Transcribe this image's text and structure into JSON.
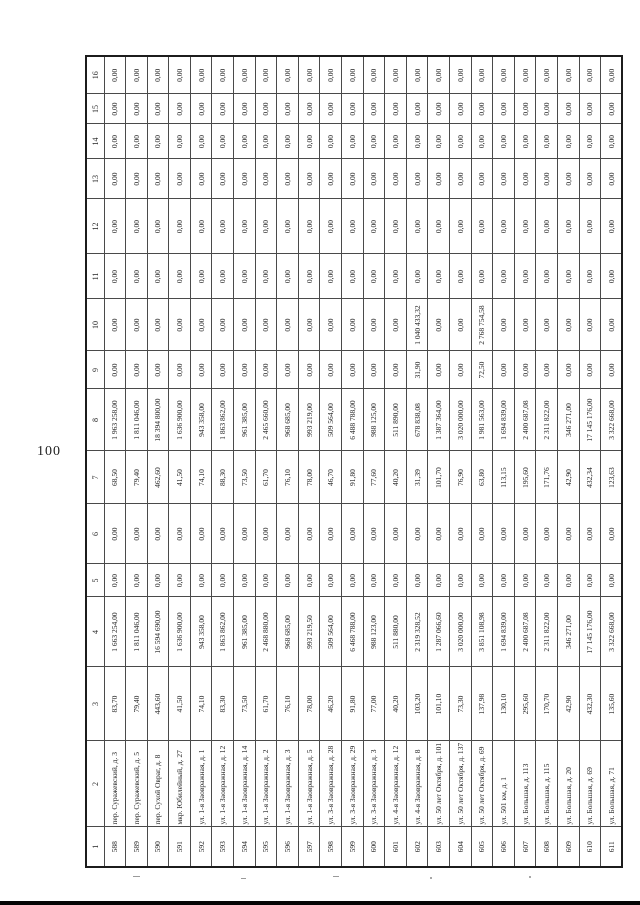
{
  "page": {
    "number": "100"
  },
  "table": {
    "col_headers": [
      "1",
      "2",
      "3",
      "4",
      "5",
      "6",
      "7",
      "8",
      "9",
      "10",
      "11",
      "12",
      "13",
      "14",
      "15",
      "16"
    ],
    "rows": [
      {
        "num": "588",
        "address": "пер. Суражевский, д. 3",
        "values": [
          "83,70",
          "1 663 254,00",
          "0,00",
          "0,00",
          "68,50",
          "1 963 258,00",
          "0,00",
          "0,00",
          "0,00",
          "0,00",
          "0,00",
          "0,00",
          "0,00",
          "0,00"
        ]
      },
      {
        "num": "589",
        "address": "пер. Суражевский, д. 5",
        "values": [
          "79,40",
          "1 811 046,00",
          "0,00",
          "0,00",
          "79,40",
          "1 811 046,00",
          "0,00",
          "0,00",
          "0,00",
          "0,00",
          "0,00",
          "0,00",
          "0,00",
          "0,00"
        ]
      },
      {
        "num": "590",
        "address": "пер. Сухой Овраг, д. 8",
        "values": [
          "443,60",
          "16 594 690,00",
          "0,00",
          "0,00",
          "462,60",
          "18 394 800,00",
          "0,00",
          "0,00",
          "0,00",
          "0,00",
          "0,00",
          "0,00",
          "0,00",
          "0,00"
        ]
      },
      {
        "num": "591",
        "address": "мкр. Юбилейный, д. 27",
        "values": [
          "41,50",
          "1 636 900,00",
          "0,00",
          "0,00",
          "41,50",
          "1 636 900,00",
          "0,00",
          "0,00",
          "0,00",
          "0,00",
          "0,00",
          "0,00",
          "0,00",
          "0,00"
        ]
      },
      {
        "num": "592",
        "address": "ул. 1-я Заовражная, д. 1",
        "values": [
          "74,10",
          "943 358,00",
          "0,00",
          "0,00",
          "74,10",
          "943 358,00",
          "0,00",
          "0,00",
          "0,00",
          "0,00",
          "0,00",
          "0,00",
          "0,00",
          "0,00"
        ]
      },
      {
        "num": "593",
        "address": "ул. 1-я Заовражная, д. 12",
        "values": [
          "83,30",
          "1 863 862,00",
          "0,00",
          "0,00",
          "88,30",
          "1 863 862,00",
          "0,00",
          "0,00",
          "0,00",
          "0,00",
          "0,00",
          "0,00",
          "0,00",
          "0,00"
        ]
      },
      {
        "num": "594",
        "address": "ул. 1-я Заовражная, д. 14",
        "values": [
          "73,50",
          "961 385,00",
          "0,00",
          "0,00",
          "73,50",
          "961 385,00",
          "0,00",
          "0,00",
          "0,00",
          "0,00",
          "0,00",
          "0,00",
          "0,00",
          "0,00"
        ]
      },
      {
        "num": "595",
        "address": "ул. 1-я Заовражная, д. 2",
        "values": [
          "61,70",
          "2 468 880,00",
          "0,00",
          "0,00",
          "61,70",
          "2 465 660,00",
          "0,00",
          "0,00",
          "0,00",
          "0,00",
          "0,00",
          "0,00",
          "0,00",
          "0,00"
        ]
      },
      {
        "num": "596",
        "address": "ул. 1-я Заовражная, д. 3",
        "values": [
          "76,10",
          "968 685,00",
          "0,00",
          "0,00",
          "76,10",
          "968 685,00",
          "0,00",
          "0,00",
          "0,00",
          "0,00",
          "0,00",
          "0,00",
          "0,00",
          "0,00"
        ]
      },
      {
        "num": "597",
        "address": "ул. 1-я Заовражная, д. 5",
        "values": [
          "78,00",
          "993 219,50",
          "0,00",
          "0,00",
          "78,00",
          "993 219,00",
          "0,00",
          "0,00",
          "0,00",
          "0,00",
          "0,00",
          "0,00",
          "0,00",
          "0,00"
        ]
      },
      {
        "num": "598",
        "address": "ул. 3-я Заовражная, д. 28",
        "values": [
          "46,20",
          "509 564,00",
          "0,00",
          "0,00",
          "46,70",
          "509 564,00",
          "0,00",
          "0,00",
          "0,00",
          "0,00",
          "0,00",
          "0,00",
          "0,00",
          "0,00"
        ]
      },
      {
        "num": "599",
        "address": "ул. 3-я Заовражная, д. 29",
        "values": [
          "91,80",
          "6 468 788,00",
          "0,00",
          "0,00",
          "91,80",
          "6 488 788,00",
          "0,00",
          "0,00",
          "0,00",
          "0,00",
          "0,00",
          "0,00",
          "0,00",
          "0,00"
        ]
      },
      {
        "num": "600",
        "address": "ул. 3-я Заовражная, д. 3",
        "values": [
          "77,00",
          "988 123,00",
          "0,00",
          "0,00",
          "77,60",
          "988 125,00",
          "0,00",
          "0,00",
          "0,00",
          "0,00",
          "0,00",
          "0,00",
          "0,00",
          "0,00"
        ]
      },
      {
        "num": "601",
        "address": "ул. 4-я Заовражная, д. 12",
        "values": [
          "40,20",
          "511 880,00",
          "0,00",
          "0,00",
          "40,20",
          "511 890,00",
          "0,00",
          "0,00",
          "0,00",
          "0,00",
          "0,00",
          "0,00",
          "0,00",
          "0,00"
        ]
      },
      {
        "num": "602",
        "address": "ул. 4-я Заовражная, д. 8",
        "values": [
          "103,20",
          "2 319 328,52",
          "0,00",
          "0,00",
          "31,39",
          "678 838,08",
          "31,90",
          "1 040 433,32",
          "0,00",
          "0,00",
          "0,00",
          "0,00",
          "0,00",
          "0,00"
        ]
      },
      {
        "num": "603",
        "address": "ул. 50 лет Октября, д. 101",
        "values": [
          "101,10",
          "1 287 066,60",
          "0,00",
          "0,00",
          "101,70",
          "1 387 364,00",
          "0,00",
          "0,00",
          "0,00",
          "0,00",
          "0,00",
          "0,00",
          "0,00",
          "0,00"
        ]
      },
      {
        "num": "604",
        "address": "ул. 50 лет Октября, д. 137",
        "values": [
          "73,30",
          "3 020 000,00",
          "0,00",
          "0,00",
          "76,90",
          "3 020 000,00",
          "0,00",
          "0,00",
          "0,00",
          "0,00",
          "0,00",
          "0,00",
          "0,00",
          "0,00"
        ]
      },
      {
        "num": "605",
        "address": "ул. 50 лет Октября, д. 69",
        "values": [
          "137,98",
          "3 851 108,98",
          "0,00",
          "0,00",
          "63,80",
          "1 981 563,00",
          "72,50",
          "2 768 754,58",
          "0,00",
          "0,00",
          "0,00",
          "0,00",
          "0,00",
          "0,00"
        ]
      },
      {
        "num": "606",
        "address": "ул. 501 км, д. 1",
        "values": [
          "130,10",
          "1 694 839,00",
          "0,00",
          "0,00",
          "113,15",
          "1 694 839,00",
          "0,00",
          "0,00",
          "0,00",
          "0,00",
          "0,00",
          "0,00",
          "0,00",
          "0,00"
        ]
      },
      {
        "num": "607",
        "address": "ул. Большая, д. 113",
        "values": [
          "295,60",
          "2 400 687,08",
          "0,00",
          "0,00",
          "195,60",
          "2 400 687,08",
          "0,00",
          "0,00",
          "0,00",
          "0,00",
          "0,00",
          "0,00",
          "0,00",
          "0,00"
        ]
      },
      {
        "num": "608",
        "address": "ул. Большая, д. 115",
        "values": [
          "170,70",
          "2 311 822,00",
          "0,00",
          "0,00",
          "171,76",
          "2 311 822,00",
          "0,00",
          "0,00",
          "0,00",
          "0,00",
          "0,00",
          "0,00",
          "0,00",
          "0,00"
        ]
      },
      {
        "num": "609",
        "address": "ул. Большая, д. 20",
        "values": [
          "42,90",
          "346 271,00",
          "0,00",
          "0,00",
          "42,90",
          "346 271,00",
          "0,00",
          "0,00",
          "0,00",
          "0,00",
          "0,00",
          "0,00",
          "0,00",
          "0,00"
        ]
      },
      {
        "num": "610",
        "address": "ул. Большая, д. 69",
        "values": [
          "432,30",
          "17 145 176,00",
          "0,00",
          "0,00",
          "432,34",
          "17 145 176,00",
          "0,00",
          "0,00",
          "0,00",
          "0,00",
          "0,00",
          "0,00",
          "0,00",
          "0,00"
        ]
      },
      {
        "num": "611",
        "address": "ул. Большая, д. 71",
        "values": [
          "135,60",
          "3 322 668,00",
          "0,00",
          "0,00",
          "123,63",
          "3 322 668,00",
          "0,00",
          "0,00",
          "0,00",
          "0,00",
          "0,00",
          "0,00",
          "0,00",
          "0,00"
        ]
      }
    ]
  }
}
